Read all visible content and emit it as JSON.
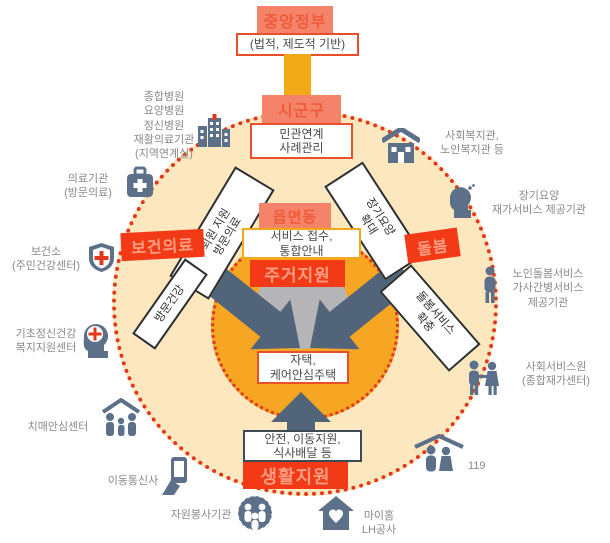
{
  "nodes": {
    "central_gov": "중앙정부",
    "legal_base": "(법적, 제도적 기반)",
    "sigungu": "시군구",
    "linkage": [
      "민관연계",
      "사례관리"
    ],
    "eupmyeondong": "읍면동",
    "service_intake": [
      "서비스 접수,",
      "통합안내"
    ],
    "housing_support": "주거지원",
    "home": [
      "자택,",
      "케어안심주택"
    ],
    "safety": [
      "안전, 이동지원,",
      "식사배달 등"
    ],
    "life_support": "생활지원",
    "health_care": "보건의료",
    "care": "돌봄"
  },
  "flows": {
    "discharge": [
      "퇴원 지원",
      "방문의료"
    ],
    "visit_health": "방문건강",
    "longterm_expand": [
      "장기요양",
      "확대"
    ],
    "care_expand": [
      "돌봄서비스",
      "확충"
    ]
  },
  "partners": {
    "hospitals": [
      "종합병원",
      "요양병원",
      "정신병원",
      "재활의료기관",
      "(지역연계실)"
    ],
    "medical": [
      "의료기관",
      "(방문의료)"
    ],
    "health_center": [
      "보건소",
      "(주민건강센터)"
    ],
    "mental": [
      "기초정신건강",
      "복지지원센터"
    ],
    "dementia": "치매안심센터",
    "telecom": "이동통신사",
    "volunteer": "자원봉사기관",
    "myhome": [
      "마이홈",
      "LH공사"
    ],
    "rescue": "119",
    "social_service": [
      "사회서비스원",
      "(종합재가센터)"
    ],
    "elder_care": [
      "노인돌봄서비스",
      "가사간병서비스",
      "제공기관"
    ],
    "longterm_provider": [
      "장기요양",
      "재가서비스 제공기관"
    ],
    "welfare": [
      "사회복지관,",
      "노인복지관 등"
    ]
  },
  "colors": {
    "coral": "#F4836A",
    "red": "#F23A16",
    "orange": "#F6A623",
    "cream": "#FCE7BE",
    "dot_red": "#E2371D",
    "slate_icon": "#5C7189",
    "arrow": "#51647A",
    "gray_circle": "#B5B5B8"
  }
}
